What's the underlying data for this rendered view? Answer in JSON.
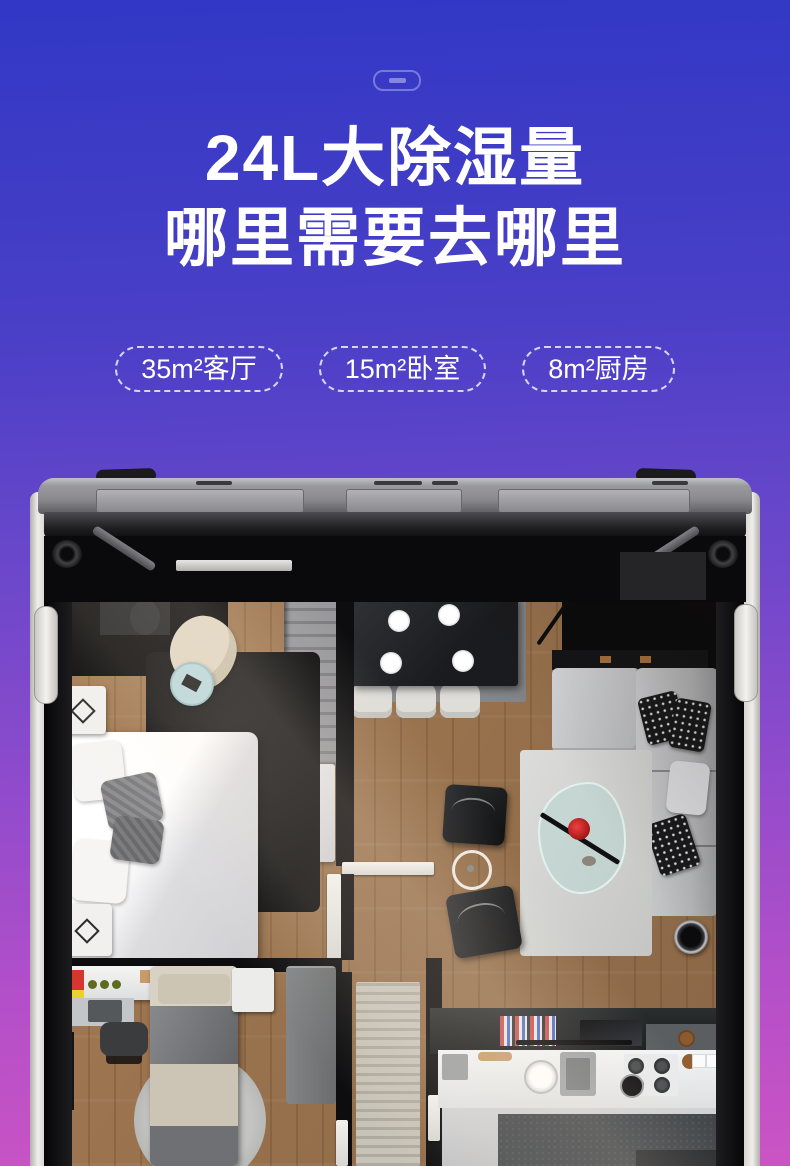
{
  "header": {
    "port_icon": "charging-port-icon",
    "title_line1": "24L大除湿量",
    "title_line2": "哪里需要去哪里",
    "badges": [
      {
        "label": "35m²客厅"
      },
      {
        "label": "15m²卧室"
      },
      {
        "label": "8m²厨房"
      }
    ]
  },
  "colors": {
    "background_top": "#3138c5",
    "background_middle": "#8f4bcc",
    "background_bottom": "#cb54c4",
    "title_text": "#ffffff",
    "badge_border": "#ffffff",
    "frame_gray": "#8a8a8e",
    "frame_white_edge": "#efeeea",
    "wood_floor": "#9a7450",
    "accent_flower_red": "#d8242a",
    "plant_green": "#3f7d22"
  }
}
